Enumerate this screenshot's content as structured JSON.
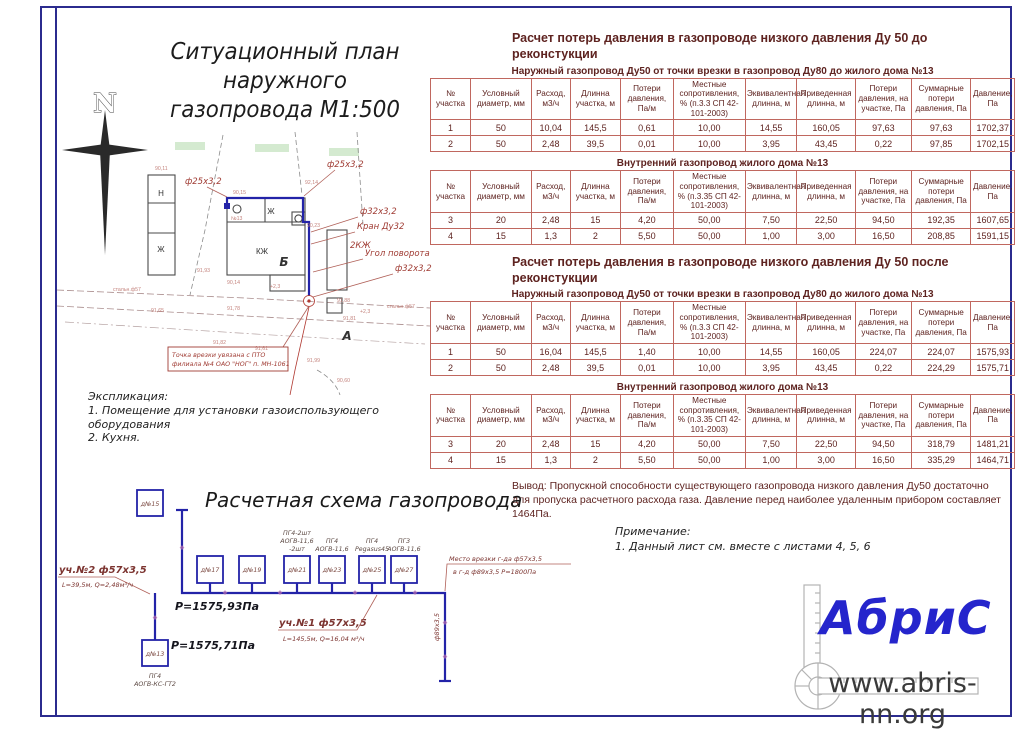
{
  "plan": {
    "title1": "Ситуационный план наружного",
    "title2": "газопровода М1:500",
    "north": "N",
    "callout_f25_left": "ф25х3,2",
    "callout_f25_right": "ф25х3,2",
    "callout_f32_top": "ф32х3,2",
    "callout_kran": "Кран Ду32",
    "callout_ugol": "Угол поворота",
    "callout_f32_bottom": "ф32х3,2",
    "label_n": "Н",
    "label_j_left": "Ж",
    "label_j_top": "Ж",
    "label_kj": "КЖ",
    "label_2kj": "2КЖ",
    "label_b": "Б",
    "label_a": "А",
    "label_no13": "№13",
    "label_steel_left": "стальн.ф57",
    "label_steel_right": "стальн.ф57",
    "note_line1": "Точка врезки увязана с ПТО",
    "note_line2": "филиала №4 ОАО \"НОГ\" п. МН-1061",
    "elevations": [
      "90,11",
      "90,15",
      "92,14",
      "90,23",
      "91,93",
      "90,14",
      "91,88",
      "91,78",
      "91,65",
      "91,81",
      "91,82",
      "91,61",
      "91,99",
      "90,60",
      "+2,3",
      "+2,3"
    ],
    "explication_title": "Экспликация:",
    "explication_1": "1. Помещение для установки газоиспользующего оборудования",
    "explication_2": "2. Кухня."
  },
  "calc": {
    "block1_title": "Расчет потерь давления в газопроводе низкого давления Ду 50 до реконстукции",
    "block2_title": "Расчет потерь давления в газопроводе низкого давления Ду 50 после реконстукции",
    "table1": {
      "subtitle": "Наружный газопровод Ду50 от точки врезки в газопровод Ду80 до жилого дома №13",
      "headers": [
        "№ участка",
        "Условный диаметр, мм",
        "Расход, м3/ч",
        "Длинна участка, м",
        "Потери давления, Па/м",
        "Местные сопротивления, % (п.3.3 СП 42-101-2003)",
        "Эквивалентная длинна, м",
        "Приведенная длинна, м",
        "Потери давления, на участке, Па",
        "Суммарные потери давления, Па",
        "Давление, Па"
      ],
      "rows": [
        [
          "1",
          "50",
          "10,04",
          "145,5",
          "0,61",
          "10,00",
          "14,55",
          "160,05",
          "97,63",
          "97,63",
          "1702,37"
        ],
        [
          "2",
          "50",
          "2,48",
          "39,5",
          "0,01",
          "10,00",
          "3,95",
          "43,45",
          "0,22",
          "97,85",
          "1702,15"
        ]
      ]
    },
    "table2": {
      "subtitle": "Внутренний газопровод жилого дома №13",
      "headers": [
        "№ участка",
        "Условный диаметр, мм",
        "Расход, м3/ч",
        "Длинна участка, м",
        "Потери давления, Па/м",
        "Местные сопротивления, % (п.3.35 СП 42-101-2003)",
        "Эквивалентная длинна, м",
        "Приведенная длинна, м",
        "Потери давления, на участке, Па",
        "Суммарные потери давления, Па",
        "Давление, Па"
      ],
      "rows": [
        [
          "3",
          "20",
          "2,48",
          "15",
          "4,20",
          "50,00",
          "7,50",
          "22,50",
          "94,50",
          "192,35",
          "1607,65"
        ],
        [
          "4",
          "15",
          "1,3",
          "2",
          "5,50",
          "50,00",
          "1,00",
          "3,00",
          "16,50",
          "208,85",
          "1591,15"
        ]
      ]
    },
    "table3": {
      "subtitle": "Наружный газопровод Ду50 от точки врезки в газопровод Ду80 до жилого дома №13",
      "headers": [
        "№ участка",
        "Условный диаметр, мм",
        "Расход, м3/ч",
        "Длинна участка, м",
        "Потери давления, Па/м",
        "Местные сопротивления, % (п.3.3 СП 42-101-2003)",
        "Эквивалентная длинна, м",
        "Приведенная длинна, м",
        "Потери давления, на участке, Па",
        "Суммарные потери давления, Па",
        "Давление, Па"
      ],
      "rows": [
        [
          "1",
          "50",
          "16,04",
          "145,5",
          "1,40",
          "10,00",
          "14,55",
          "160,05",
          "224,07",
          "224,07",
          "1575,93"
        ],
        [
          "2",
          "50",
          "2,48",
          "39,5",
          "0,01",
          "10,00",
          "3,95",
          "43,45",
          "0,22",
          "224,29",
          "1575,71"
        ]
      ]
    },
    "table4": {
      "subtitle": "Внутренний газопровод жилого дома №13",
      "headers": [
        "№ участка",
        "Условный диаметр, мм",
        "Расход, м3/ч",
        "Длинна участка, м",
        "Потери давления, Па/м",
        "Местные сопротивления, % (п.3.35 СП 42-101-2003)",
        "Эквивалентная длинна, м",
        "Приведенная длинна, м",
        "Потери давления, на участке, Па",
        "Суммарные потери давления, Па",
        "Давление, Па"
      ],
      "rows": [
        [
          "3",
          "20",
          "2,48",
          "15",
          "4,20",
          "50,00",
          "7,50",
          "22,50",
          "94,50",
          "318,79",
          "1481,21"
        ],
        [
          "4",
          "15",
          "1,3",
          "2",
          "5,50",
          "50,00",
          "1,00",
          "3,00",
          "16,50",
          "335,29",
          "1464,71"
        ]
      ]
    },
    "conclusion": "Вывод: Пропускной способности существующего газопровода низкого давления Ду50 достаточно для пропуска расчетного расхода газа. Давление перед наиболее удаленным прибором составляет 1464Па."
  },
  "scheme": {
    "title": "Расчетная схема газопровода",
    "house_top": "д№15",
    "house_left": "д№13",
    "houses_row": [
      "д№17",
      "д№19",
      "д№21",
      "д№23",
      "д№25",
      "д№27"
    ],
    "appliances_21": [
      "ПГ4-2шт",
      "АОГВ-11,6",
      "-2шт"
    ],
    "appliances_23": [
      "ПГ4",
      "АОГВ-11,6"
    ],
    "appliances_25": [
      "ПГ4",
      "Pegasus45"
    ],
    "appliances_27": [
      "ПГ3",
      "АОГВ-11,6"
    ],
    "appliances_13": [
      "ПГ4",
      "АОГВ-КС-ГТ2"
    ],
    "seg2_name": "уч.№2 ф57х3,5",
    "seg2_params": "L=39,5м, Q=2,48м³/ч",
    "seg1_name": "уч.№1 ф57х3,5",
    "seg1_params": "L=145,5м, Q=16,04 м³/ч",
    "p_top": "P=1575,93Па",
    "p_bottom": "P=1575,71Па",
    "tie1": "Место врезки г-да ф57х3,5",
    "tie2": "в г-д ф89х3,5 Р=1800Па",
    "riser": "ф89х3,5"
  },
  "notes": {
    "title": "Примечание:",
    "item": "1. Данный лист см. вместе с листами 4, 5, 6"
  },
  "footer": {
    "logo_text": "АбриС",
    "site": "www.abris-nn.org"
  },
  "colors": {
    "frame_blue": "#2b2b8e",
    "pipe_blue": "#2323a8",
    "table_text": "#5e2320",
    "table_border": "#c0675f",
    "annotation_red": "#a03c34",
    "logo_blue": "#2525cc"
  }
}
